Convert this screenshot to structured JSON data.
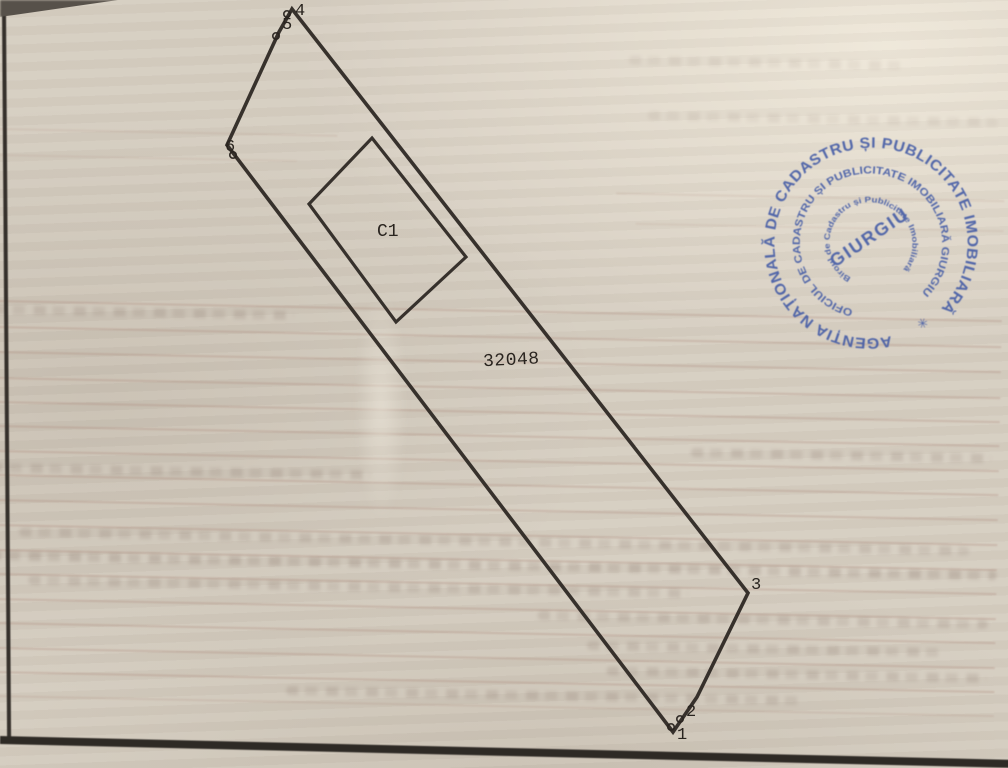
{
  "document": {
    "kind": "scanned cadastral site plan",
    "parcel_number": "32048",
    "construction_label": "C1",
    "boundary_points": [
      {
        "label": "1"
      },
      {
        "label": "2"
      },
      {
        "label": "3"
      },
      {
        "label": "4"
      },
      {
        "label": "5"
      },
      {
        "label": "6"
      }
    ]
  },
  "stamp": {
    "ring_outer": "AGENȚIA NAȚIONALĂ DE CADASTRU ȘI PUBLICITATE IMOBILIARĂ",
    "ring_middle": "OFICIUL DE CADASTRU ȘI PUBLICITATE IMOBILIARĂ GIURGIU",
    "ring_inner": "Biroul de Cadastru și Publicitate Imobiliară",
    "center": "GIURGIU",
    "separator": "✳",
    "ink_color": "#3e57a5"
  },
  "colors": {
    "paper": "#d6cec1",
    "ink": "#29241f",
    "stamp_blue": "#3e57a5"
  }
}
